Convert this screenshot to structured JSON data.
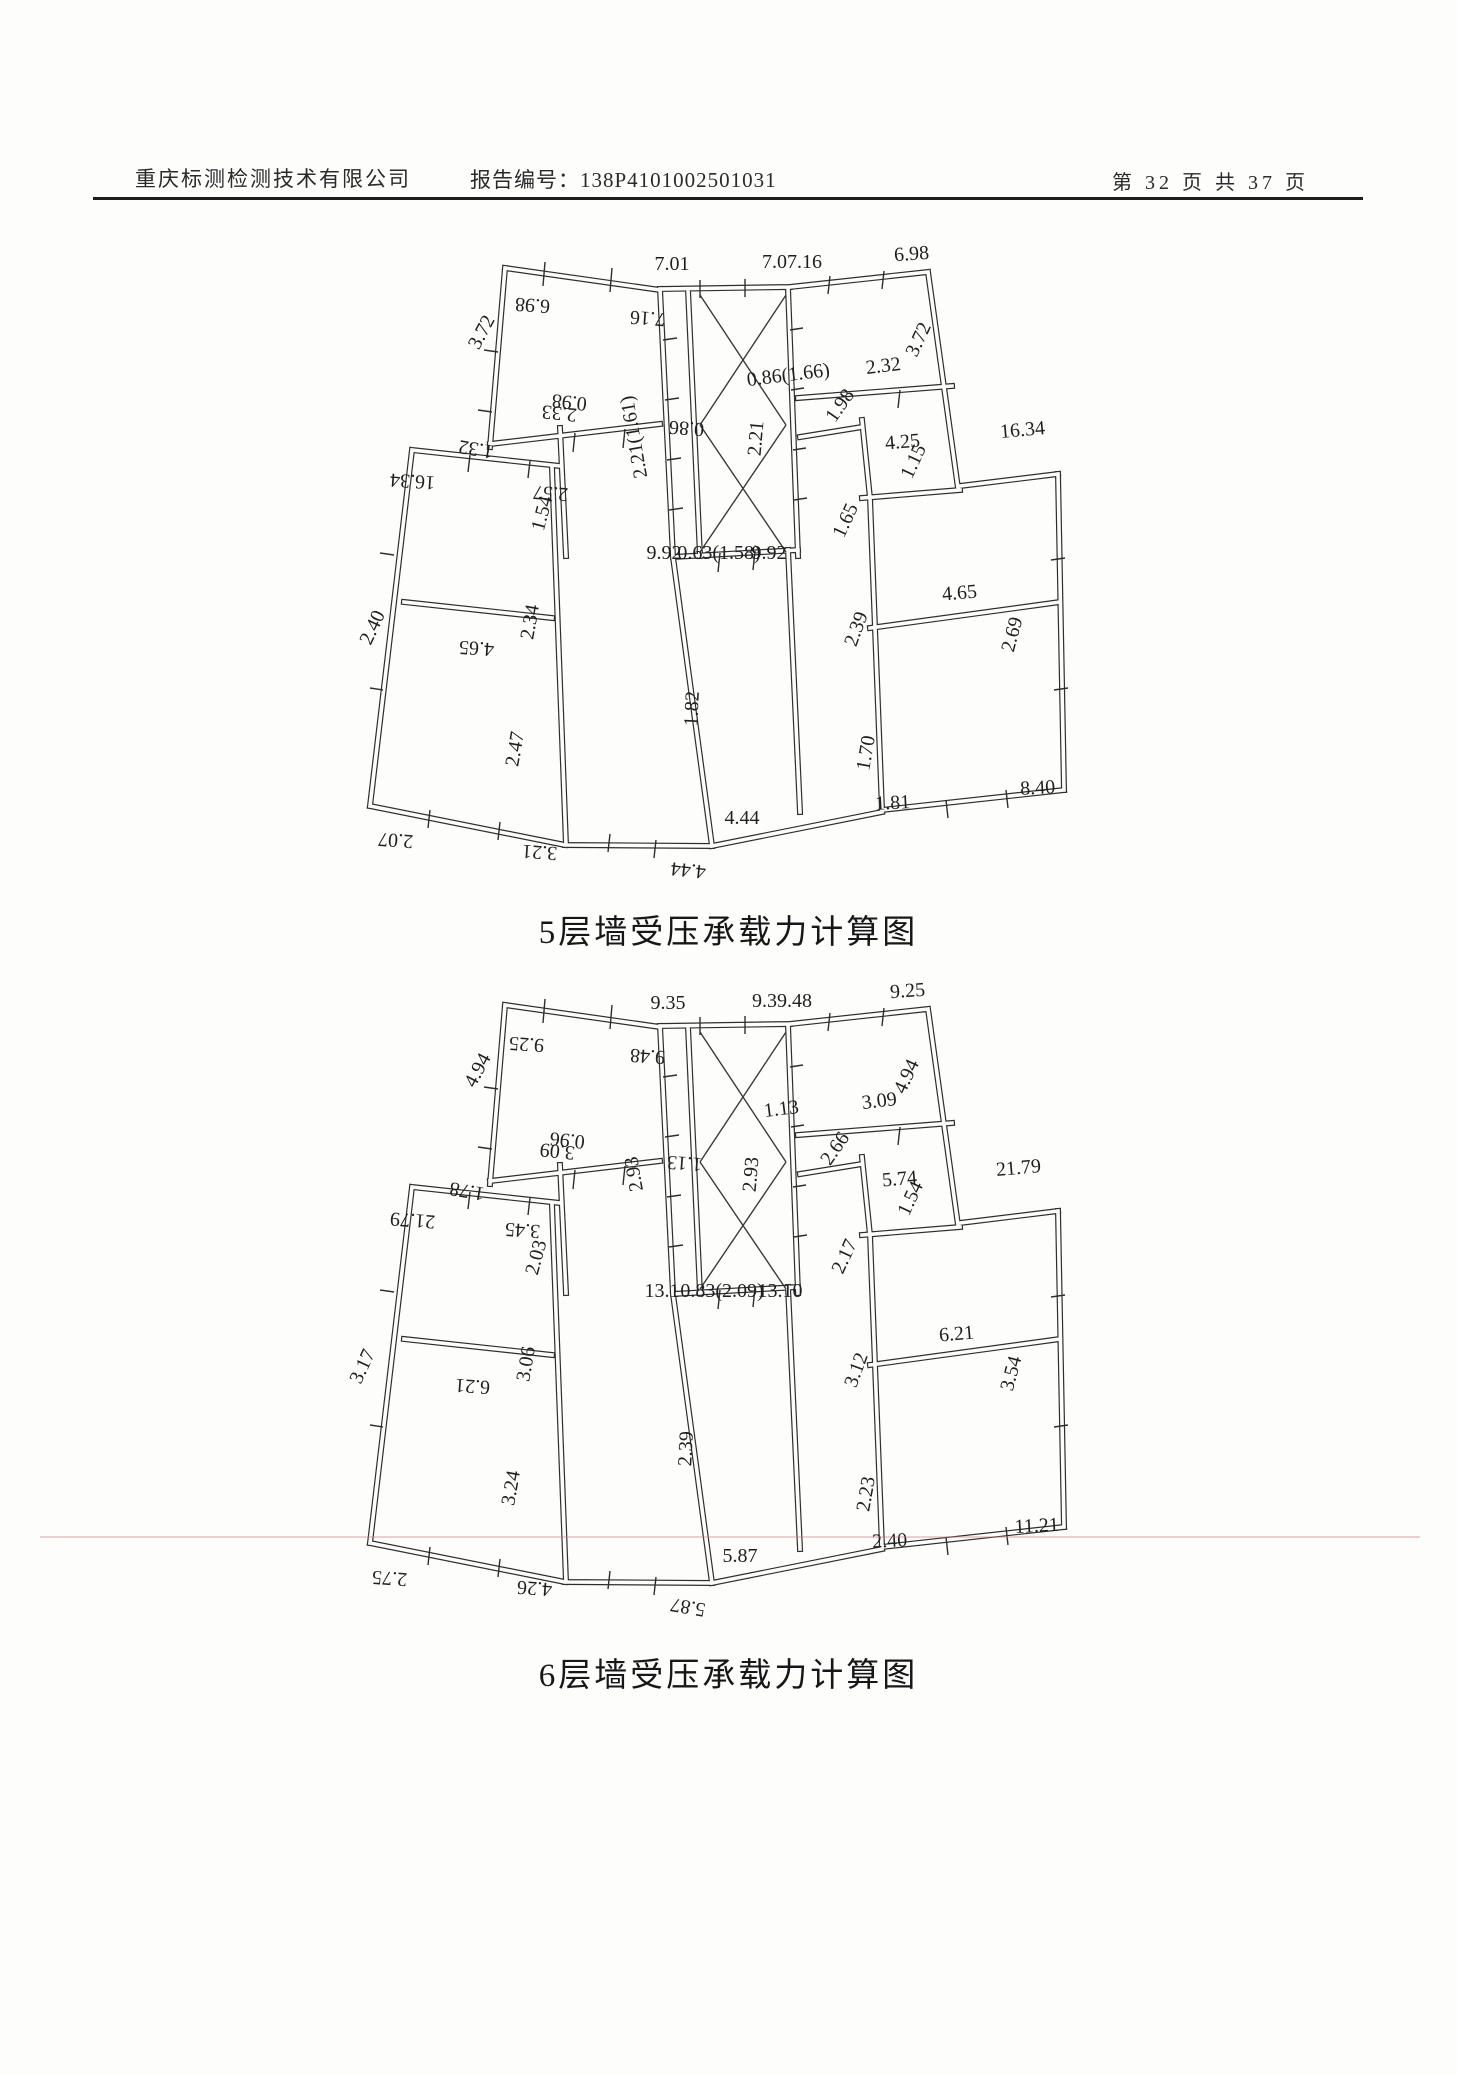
{
  "header": {
    "company": "重庆标测检测技术有限公司",
    "report_no_label": "报告编号：",
    "report_no": "138P4101002501031",
    "page_info": "第 32 页 共 37 页"
  },
  "figures": {
    "fig5": {
      "caption": "5层墙受压承载力计算图",
      "labels": [
        "7.01",
        "7.07.16",
        "6.98",
        "6.98",
        "3.72",
        "7.16",
        "2.33",
        "0.98",
        "2.21(1.61)",
        "0.86",
        "0.86(1.66)",
        "2.21",
        "1.98",
        "2.32",
        "3.72",
        "4.25",
        "1.15",
        "16.34",
        "16.34",
        "1.32",
        "2.57",
        "1.54",
        "9.92",
        "0.63(1.58)",
        "9.92",
        "2.40",
        "4.65",
        "2.34",
        "2.47",
        "1.82",
        "2.39",
        "4.65",
        "2.69",
        "1.65",
        "1.70",
        "1.81",
        "8.40",
        "4.44",
        "2.07",
        "3.21",
        "4.44"
      ]
    },
    "fig6": {
      "caption": "6层墙受压承载力计算图",
      "labels": [
        "9.35",
        "9.39.48",
        "9.25",
        "9.25",
        "4.94",
        "9.48",
        "3.09",
        "0.96",
        "2.93",
        "1.13",
        "1.13",
        "2.93",
        "2.66",
        "3.09",
        "4.94",
        "5.74",
        "1.54",
        "21.79",
        "21.79",
        "1.78",
        "3.45",
        "2.03",
        "13.1",
        "0.83(2.09)",
        "13.10",
        "3.17",
        "6.21",
        "3.06",
        "3.24",
        "2.39",
        "3.12",
        "6.21",
        "3.54",
        "2.17",
        "2.23",
        "2.40",
        "11.21",
        "5.87",
        "2.75",
        "4.26",
        "5.87"
      ]
    }
  }
}
